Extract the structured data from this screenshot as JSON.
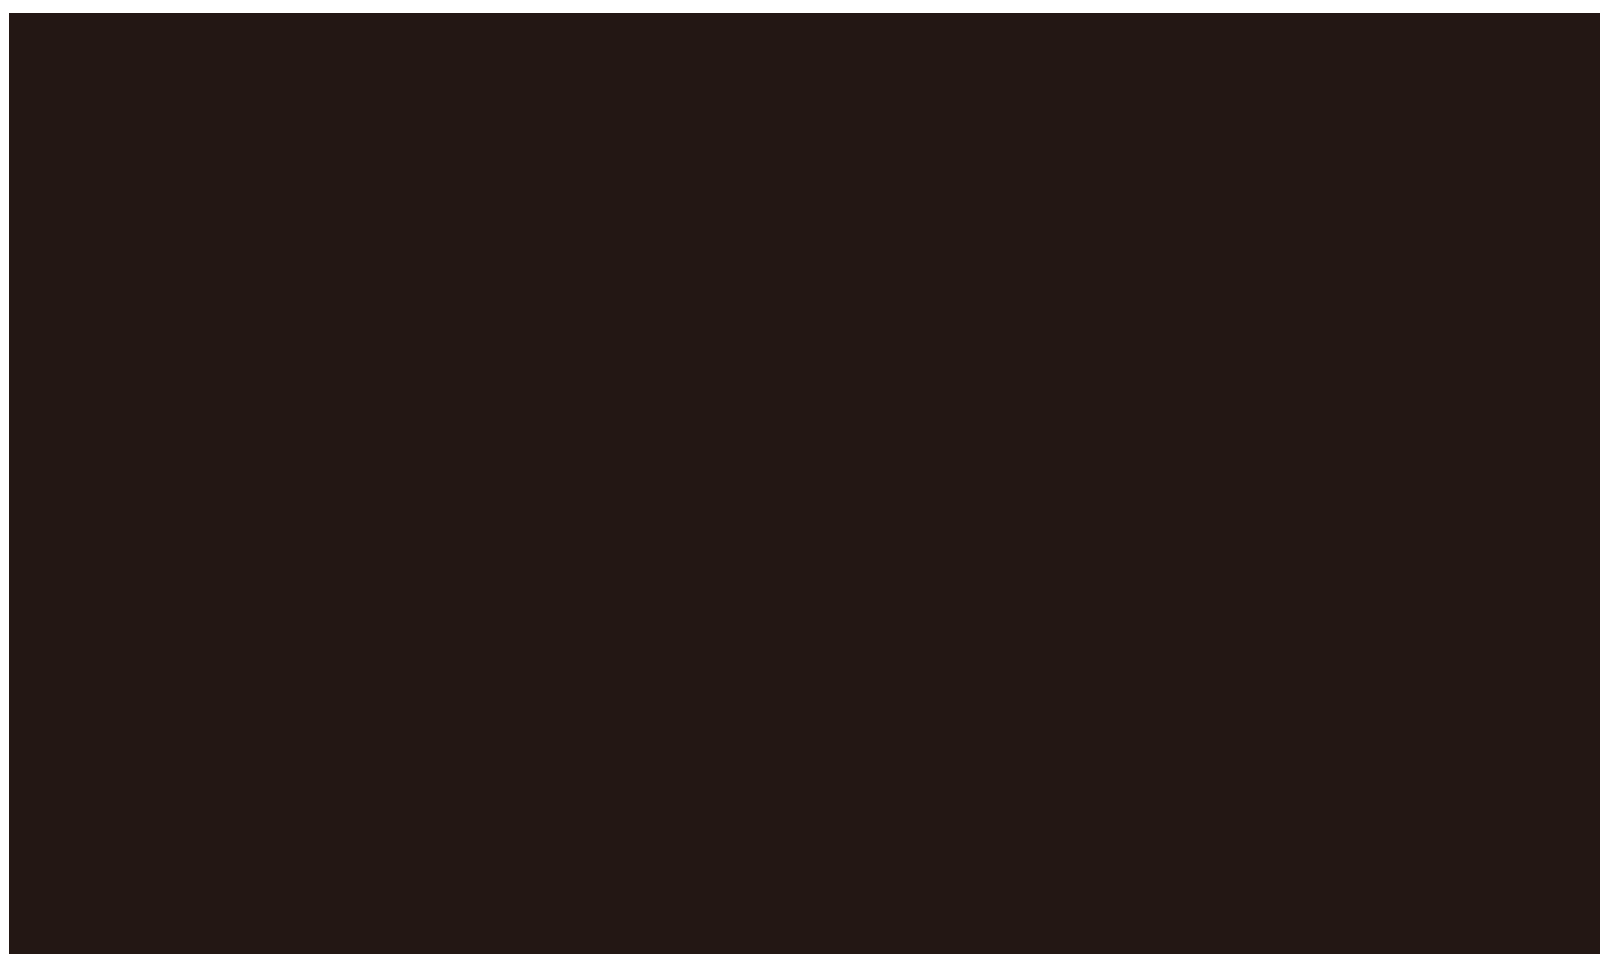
{
  "screen": {
    "state": "blank",
    "visible_text": ""
  },
  "colors": {
    "page_background": "#ffffff",
    "screen_fill": "#231714"
  }
}
